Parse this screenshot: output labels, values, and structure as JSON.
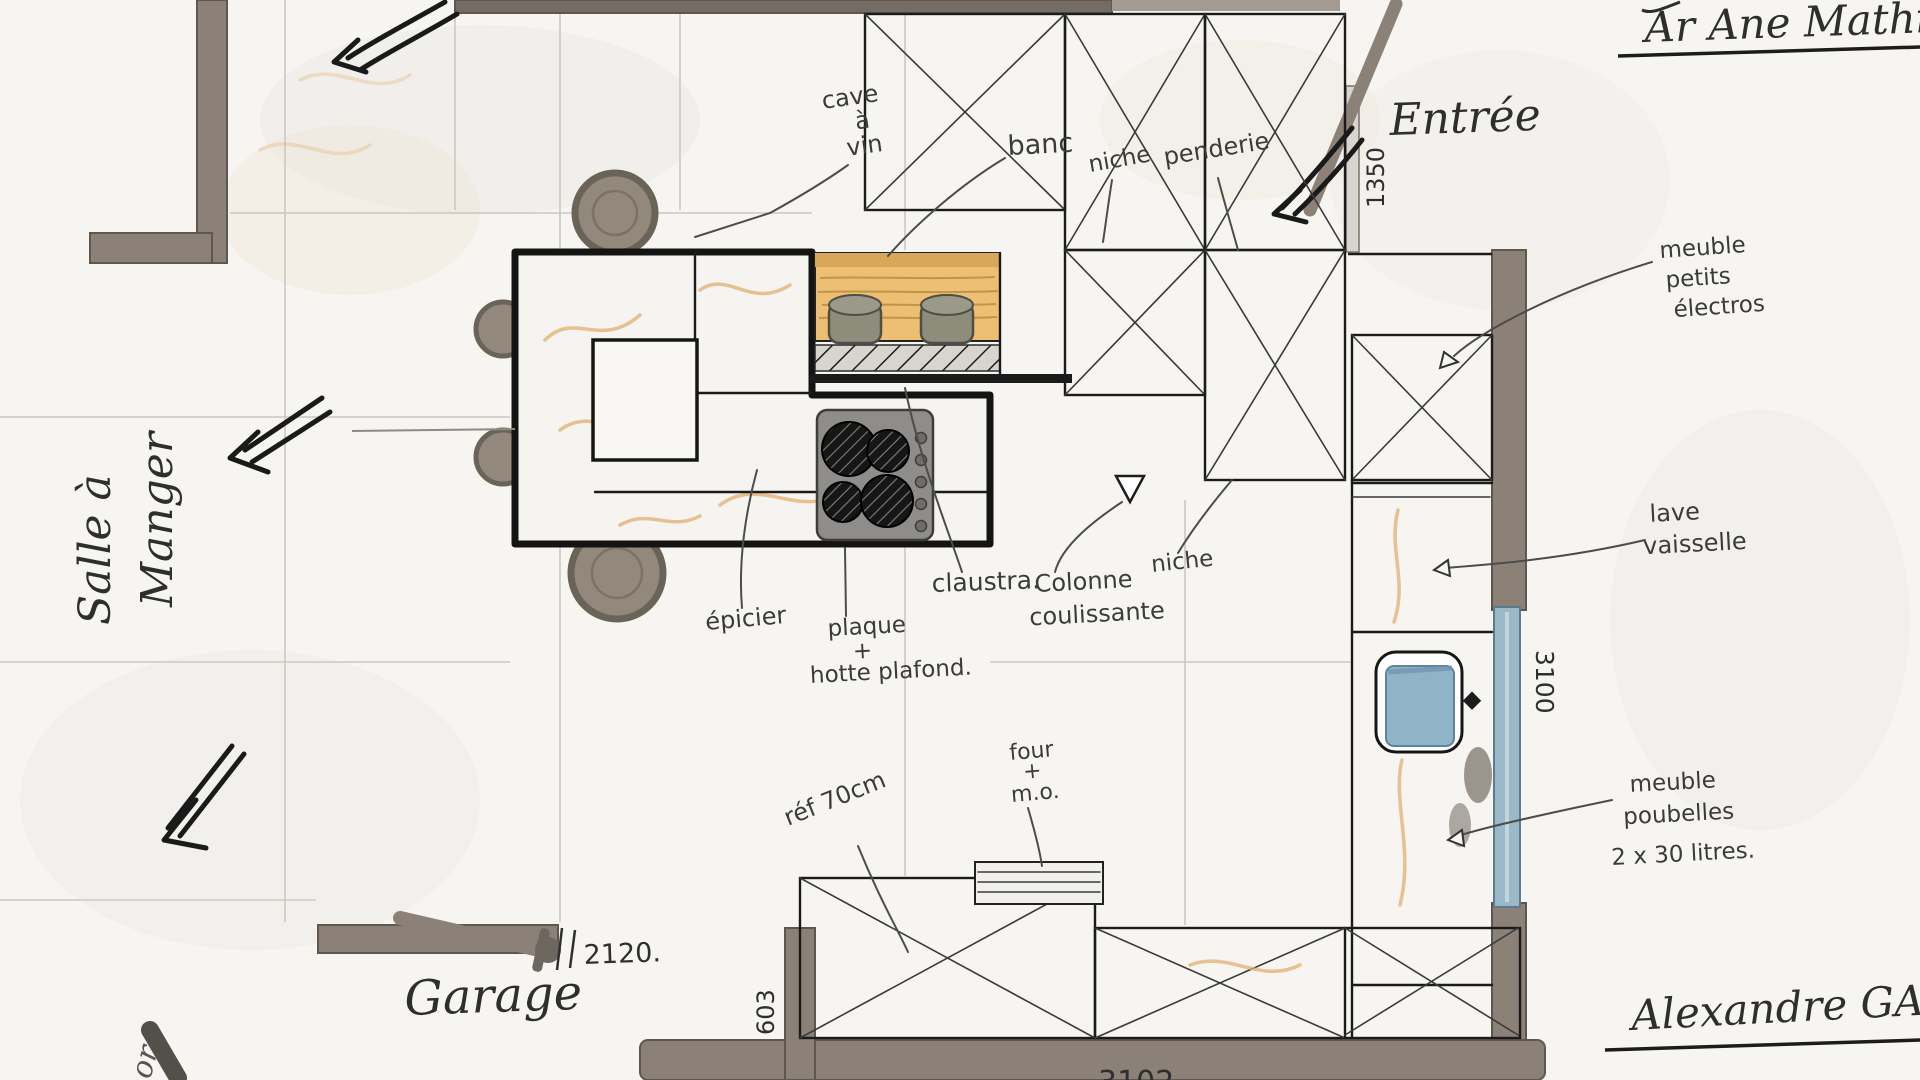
{
  "ann": {
    "salle": [
      "Salle à",
      "Manger"
    ],
    "garage": "Garage",
    "entree": "Entrée",
    "cave": [
      "cave",
      "à",
      "vin"
    ],
    "banc": "banc",
    "niche1": "niche",
    "penderie": "penderie",
    "electros": [
      "meuble",
      "petits",
      "électros"
    ],
    "claustra": "claustra.",
    "colonne": [
      "Colonne",
      "coulissante"
    ],
    "niche2": "niche",
    "lavevaisselle": [
      "lave",
      "vaisselle"
    ],
    "epicier": "épicier",
    "plaque": [
      "plaque",
      "+",
      "hotte plafond."
    ],
    "four": [
      "four",
      "+",
      "m.o."
    ],
    "ref": "réf 70cm",
    "poubelles": [
      "meuble",
      "poubelles",
      "2 x 30 litres."
    ],
    "sig_top": "Ar Ane Mathieu",
    "sig_bottom": "Alexandre GARCIA",
    "corner": "or"
  },
  "dim": {
    "entree": "1350",
    "garage": "2120.",
    "d603": "603",
    "right": "3100",
    "bottom": "3102"
  },
  "colors": {
    "paper": "#f6f5f2",
    "wall": "#8b8177",
    "ink": "#1b1b1b",
    "bench_wood": "#edbf72",
    "window_blue": "#9bb8c9",
    "sink_blue": "#8fb3c7",
    "vein_orange": "#e2af70"
  }
}
